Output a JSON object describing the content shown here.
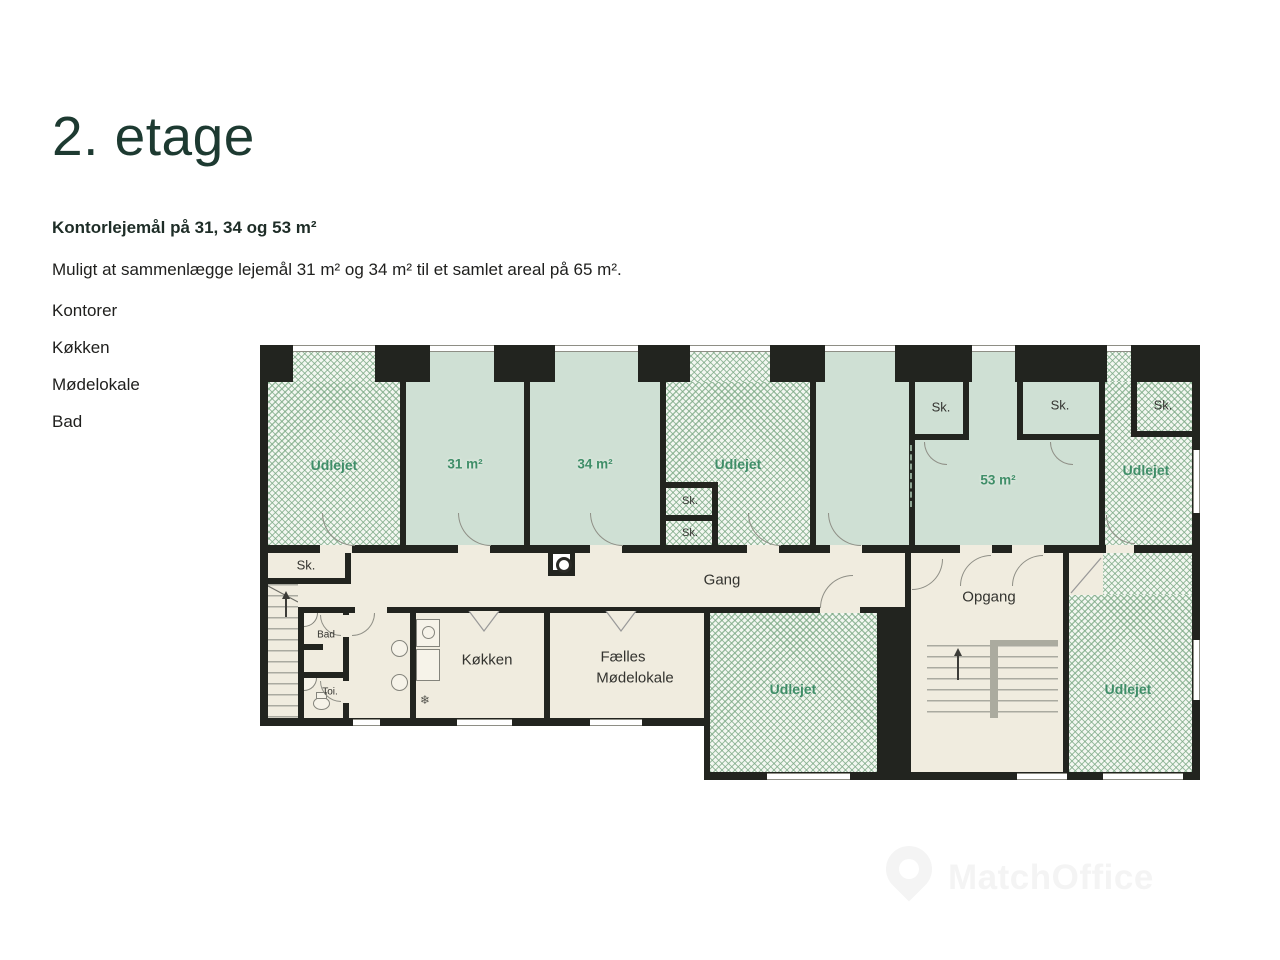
{
  "page": {
    "title": "2. etage",
    "subtitle": "Kontorlejemål på 31, 34 og 53 m²",
    "description": "Muligt at sammenlægge lejemål 31 m² og 34 m² til et samlet areal på 65 m².",
    "features": [
      "Kontorer",
      "Køkken",
      "Mødelokale",
      "Bad"
    ]
  },
  "floorplan": {
    "labels": {
      "udlejet": "Udlejet",
      "m31": "31 m²",
      "m34": "34 m²",
      "m53": "53 m²",
      "sk": "Sk.",
      "gang": "Gang",
      "opgang": "Opgang",
      "kokken": "Køkken",
      "faelles1": "Fælles",
      "faelles2": "Mødelokale",
      "bad": "Bad",
      "toi": "Toi.",
      "freezer_symbol": "❄"
    },
    "colors": {
      "wall": "#22241f",
      "room_fill": "#cfe0d4",
      "hatch_fill": "#f3f7f1",
      "hatch_line": "#7aa884",
      "corridor": "#f0ecdf",
      "label_green": "#3f8e68",
      "title": "#1d3a31",
      "watermark": "#f4f4f4"
    }
  },
  "watermark": {
    "text": "MatchOffice"
  }
}
